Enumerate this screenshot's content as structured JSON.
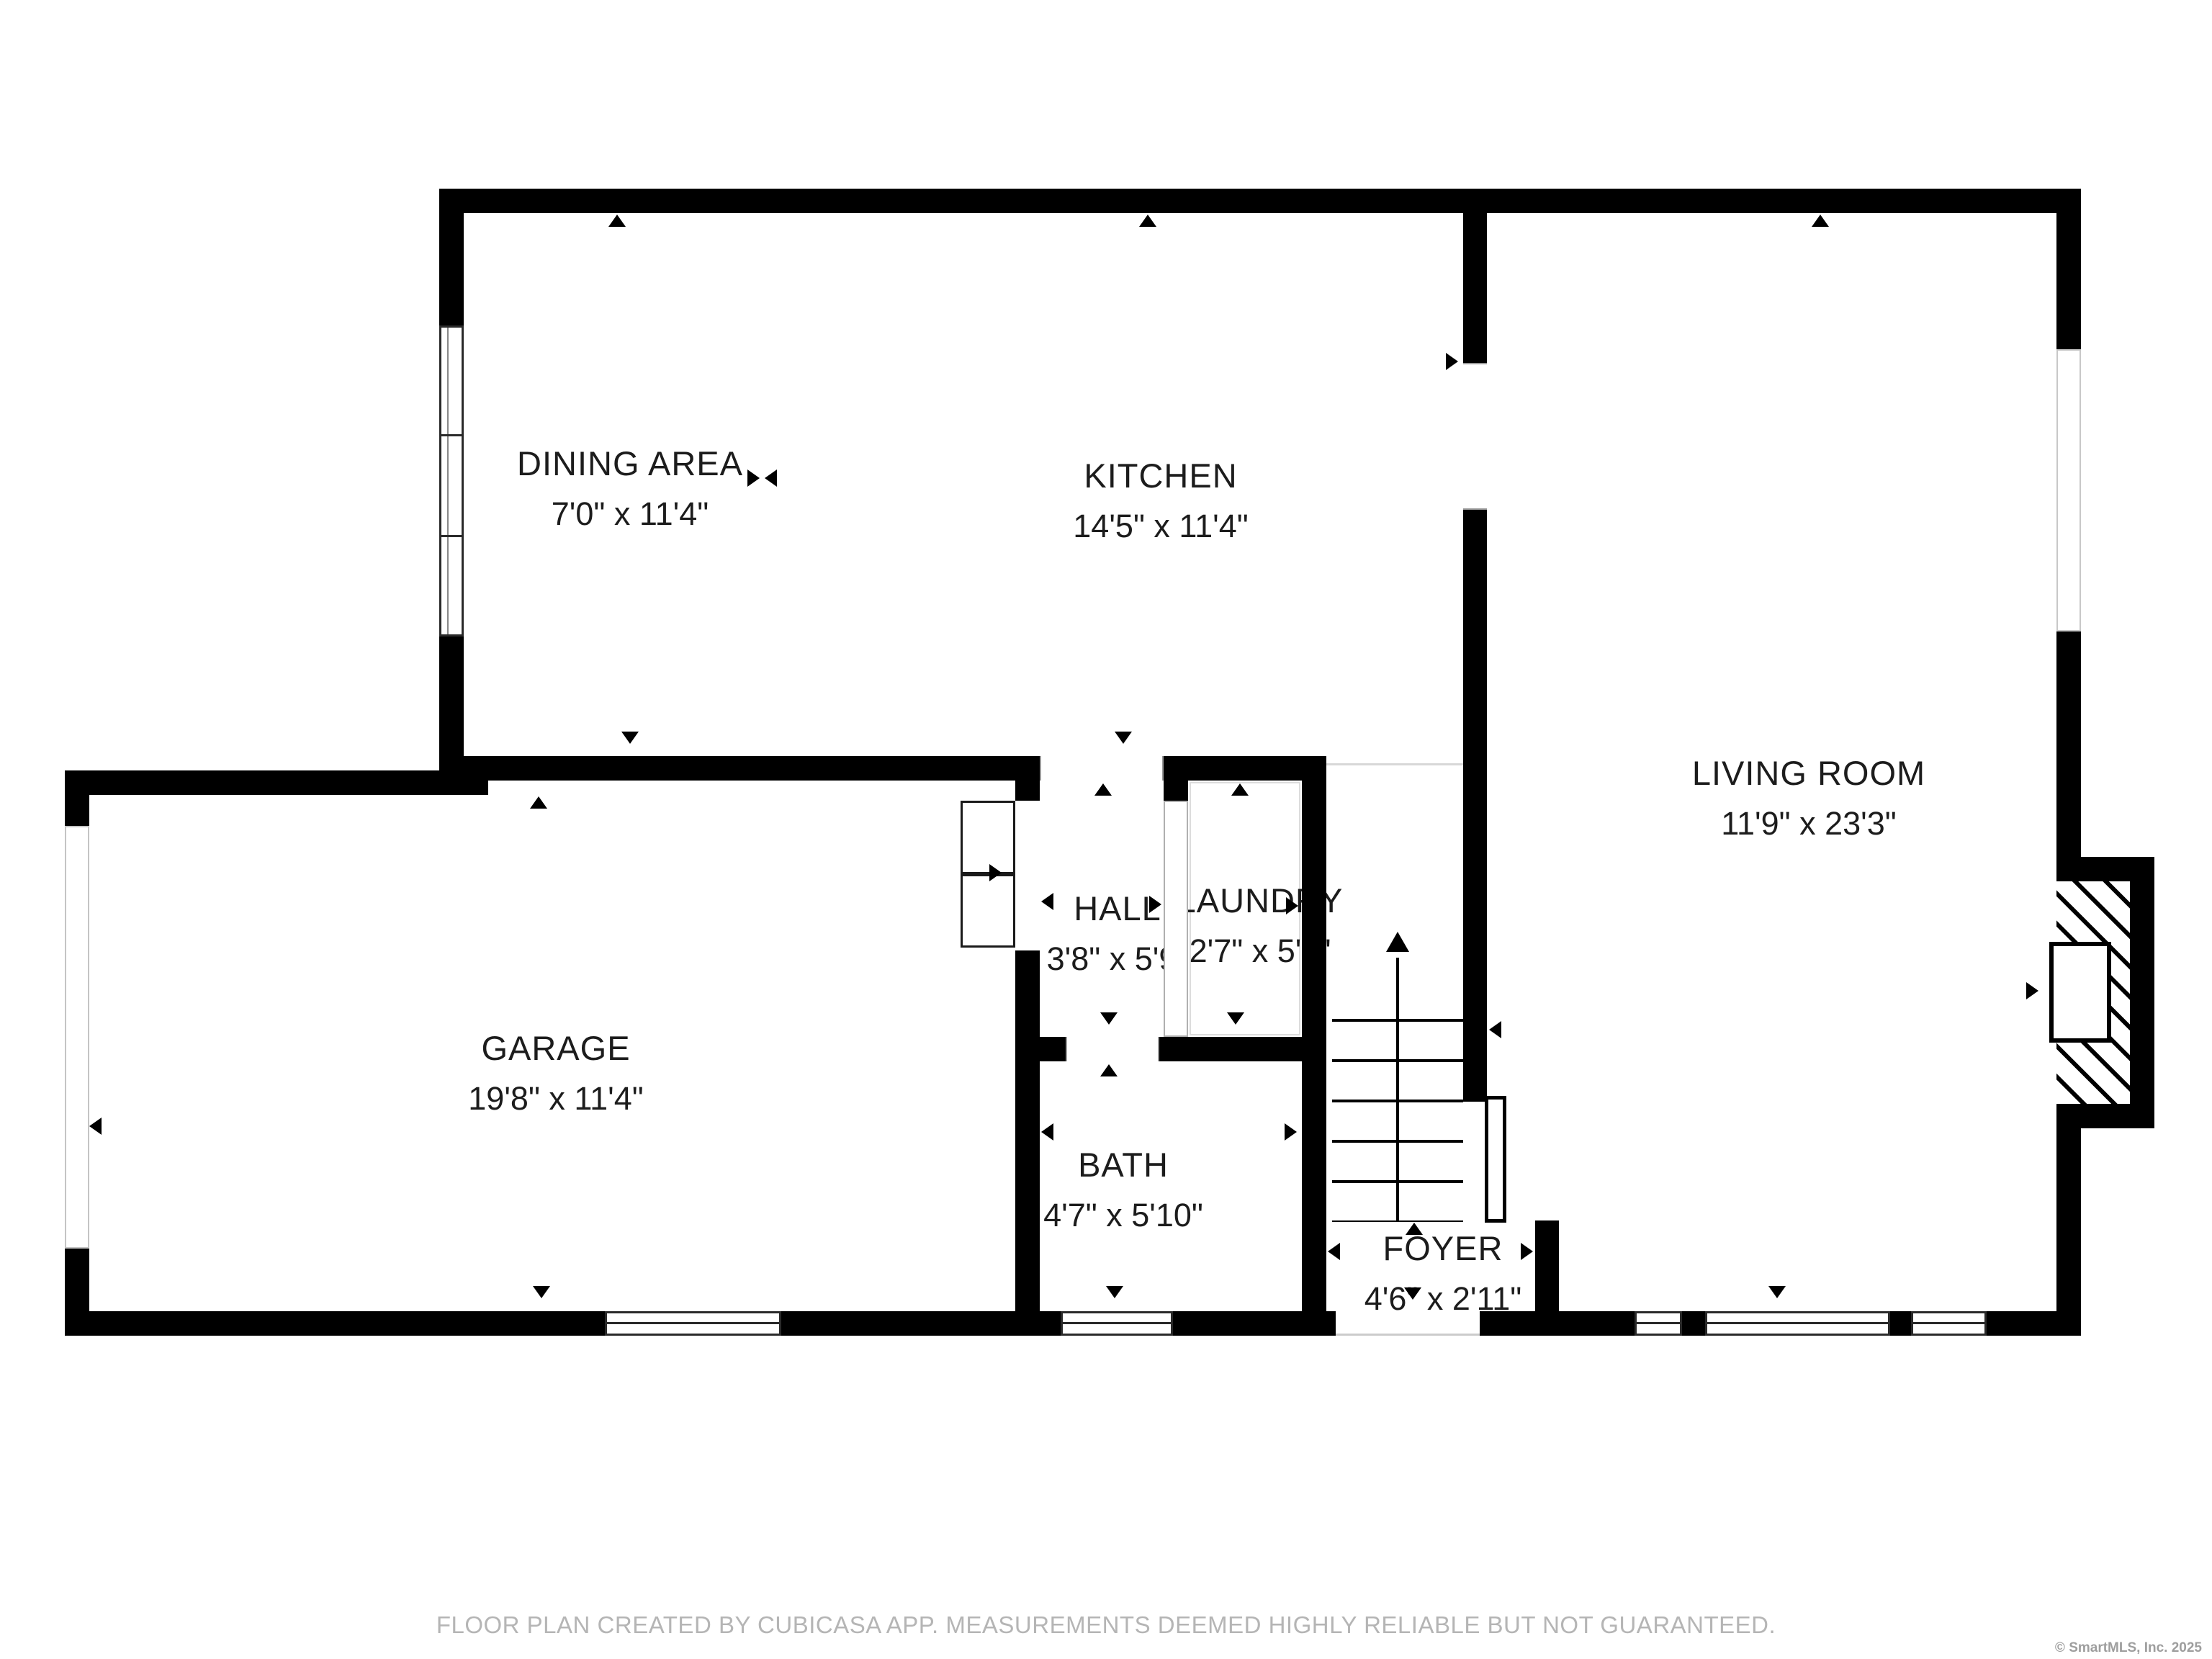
{
  "rooms": {
    "dining": {
      "name": "DINING AREA",
      "dims": "7'0\" x 11'4\""
    },
    "kitchen": {
      "name": "KITCHEN",
      "dims": "14'5\" x 11'4\""
    },
    "living": {
      "name": "LIVING ROOM",
      "dims": "11'9\" x 23'3\""
    },
    "garage": {
      "name": "GARAGE",
      "dims": "19'8\" x 11'4\""
    },
    "hall": {
      "name": "HALL",
      "dims": "3'8\" x 5'9\""
    },
    "laundry": {
      "name": "LAUNDRY",
      "dims": "2'7\" x 5'5\""
    },
    "bath": {
      "name": "BATH",
      "dims": "4'7\" x 5'10\""
    },
    "foyer": {
      "name": "FOYER",
      "dims": "4'6\" x 2'11\""
    }
  },
  "footer": {
    "disclaimer": "FLOOR PLAN CREATED BY CUBICASA APP. MEASUREMENTS DEEMED HIGHLY RELIABLE BUT NOT GUARANTEED."
  },
  "branding": {
    "copyright": "© SmartMLS, Inc.  2025"
  },
  "colors": {
    "wall": "#000000",
    "room_label": "#1c1c1c",
    "footer_text": "#b5b5b5",
    "copyright_text": "#9e9e9e",
    "window_frame": "#2a2a2a",
    "opening_frame": "#c4c4c4"
  },
  "icons": {
    "door_direction_arrow": "black triangle",
    "stairs_up_arrow": "arrow pointing up",
    "window_symbol": "white bar with center line",
    "fireplace_symbol": "diagonal hatch with firebox"
  }
}
